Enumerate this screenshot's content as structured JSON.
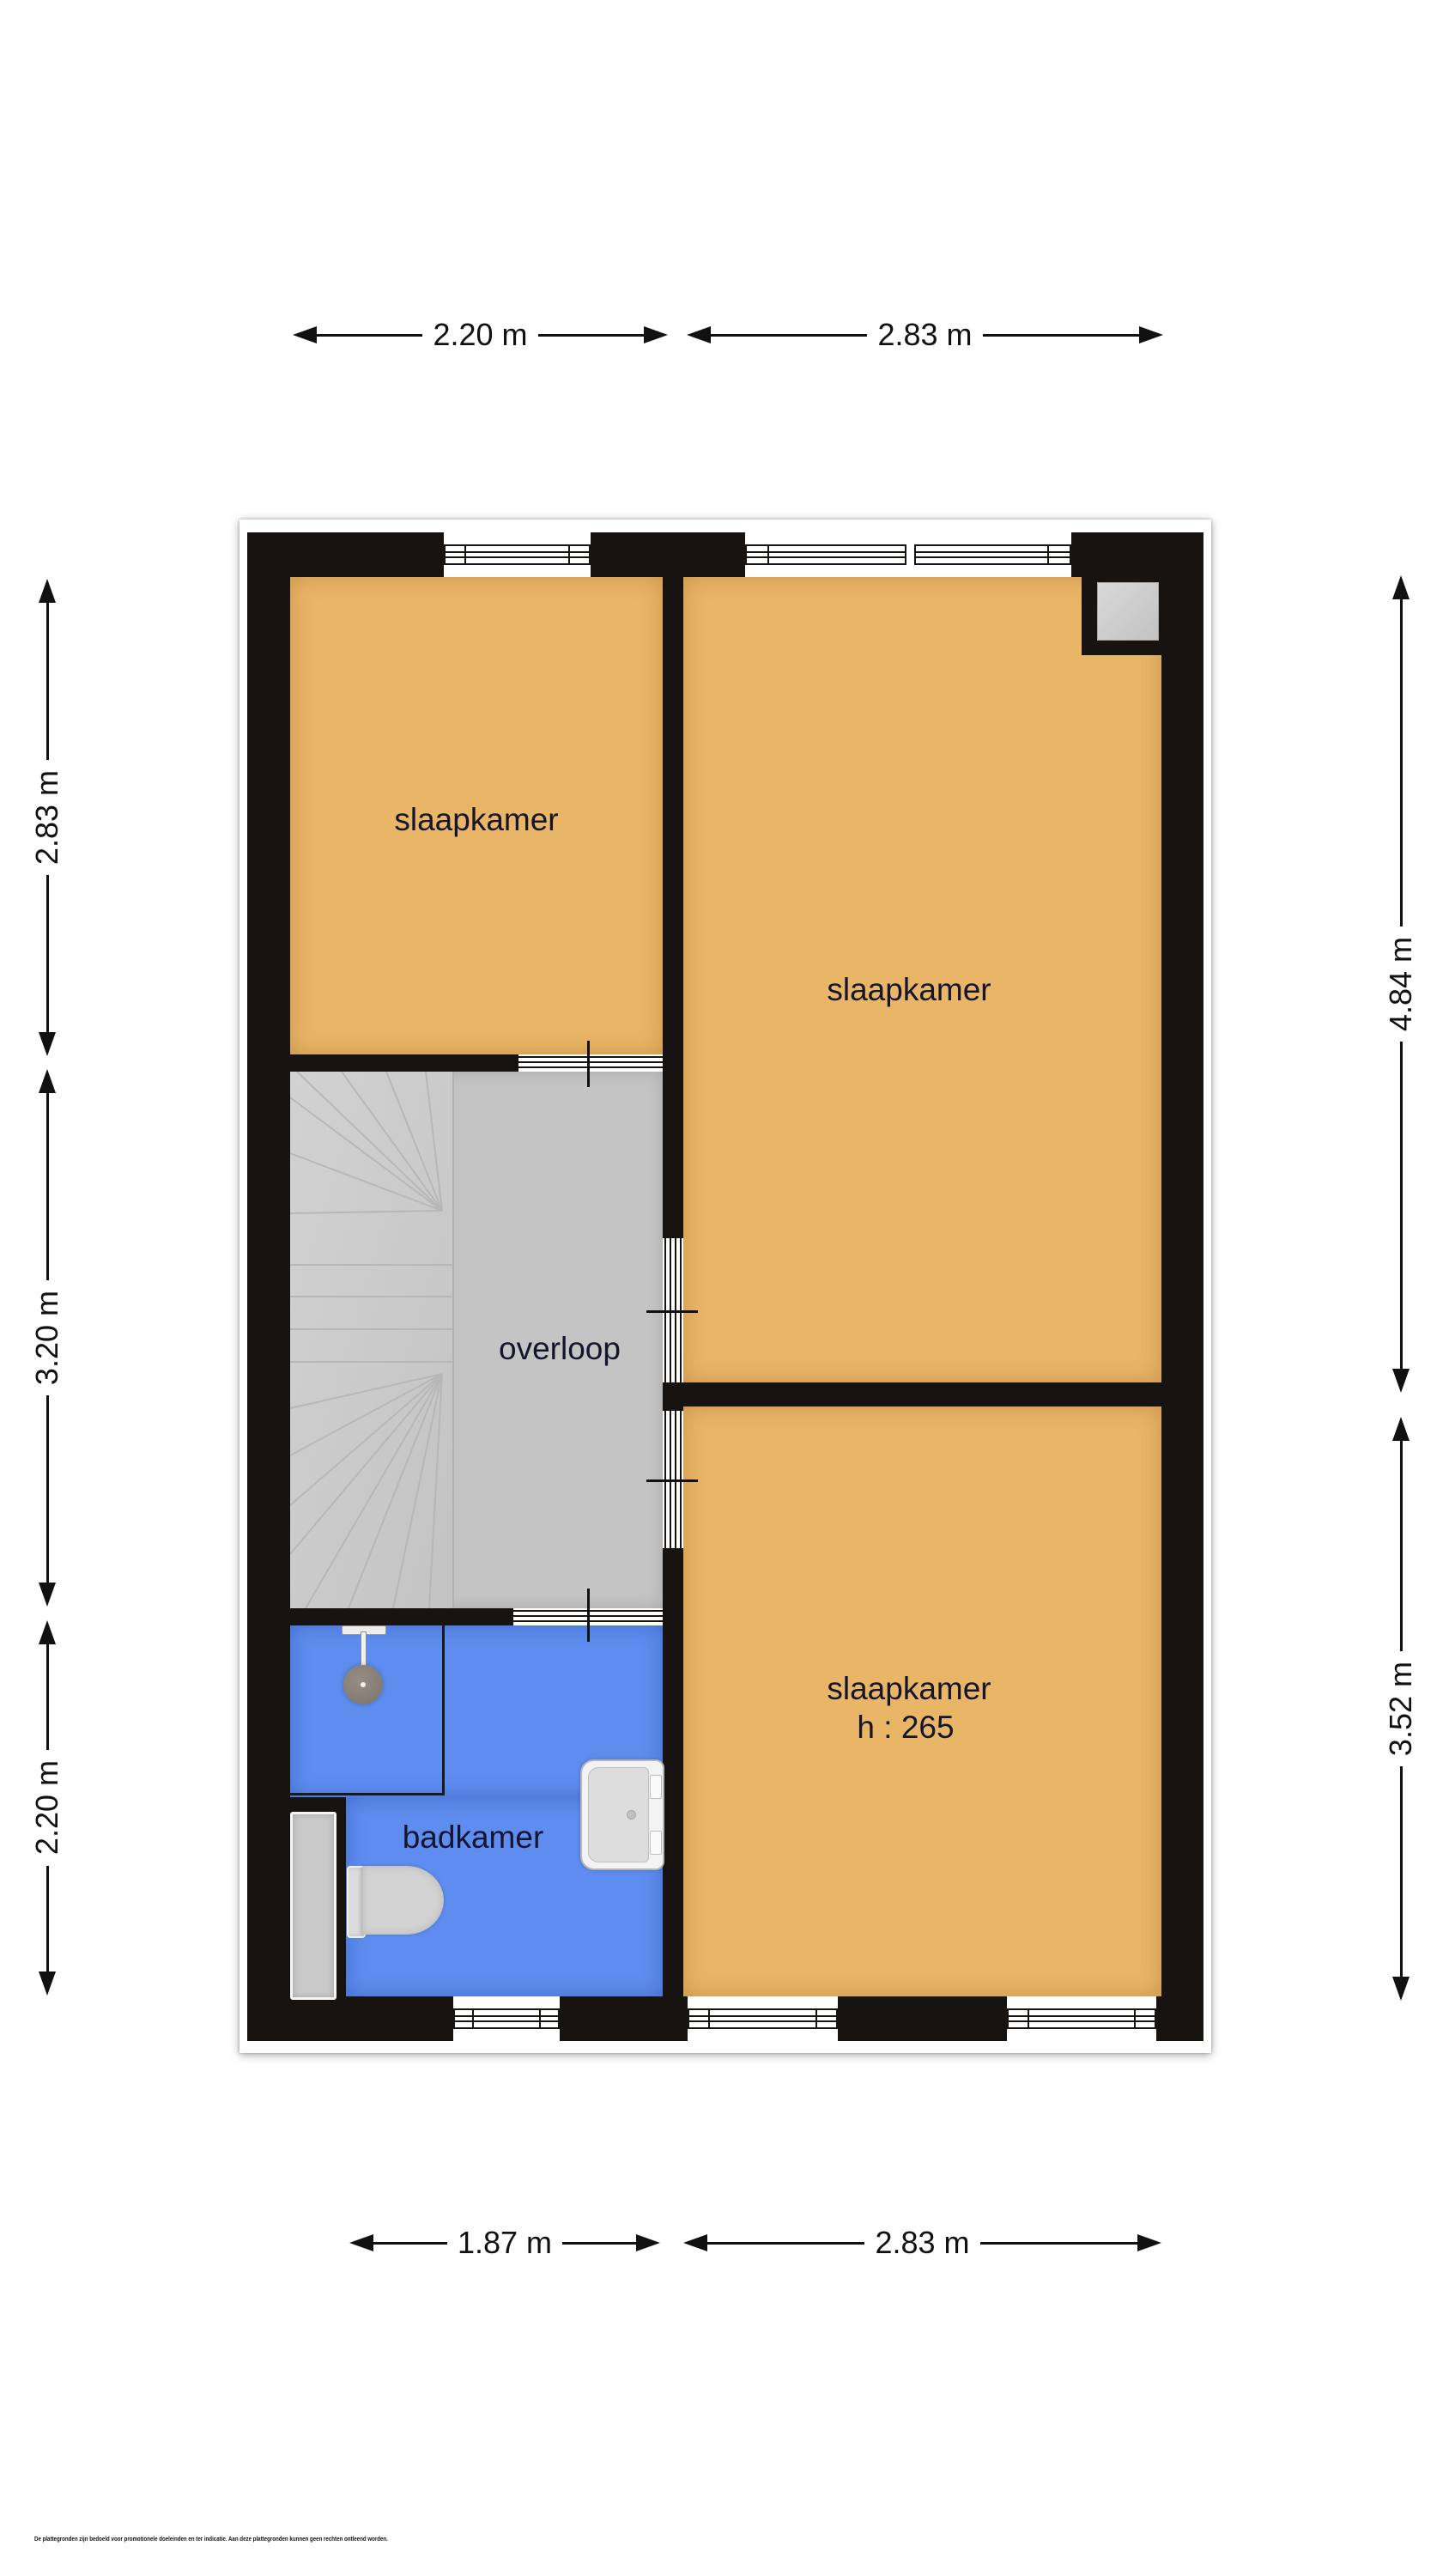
{
  "rooms": [
    {
      "id": "bedroom-top-left",
      "label": "slaapkamer"
    },
    {
      "id": "bedroom-right",
      "label": "slaapkamer"
    },
    {
      "id": "bedroom-bottom-right",
      "label": "slaapkamer",
      "ceiling_height": "h : 265"
    },
    {
      "id": "landing",
      "label": "overloop"
    },
    {
      "id": "bathroom",
      "label": "badkamer"
    }
  ],
  "dimensions": {
    "top": [
      {
        "label": "2.20 m"
      },
      {
        "label": "2.83 m"
      }
    ],
    "bottom": [
      {
        "label": "1.87 m"
      },
      {
        "label": "2.83 m"
      }
    ],
    "left": [
      {
        "label": "2.83 m"
      },
      {
        "label": "3.20 m"
      },
      {
        "label": "2.20 m"
      }
    ],
    "right": [
      {
        "label": "4.84 m"
      },
      {
        "label": "3.52 m"
      }
    ]
  },
  "fixtures": [
    {
      "name": "winder-stairs"
    },
    {
      "name": "shower-head"
    },
    {
      "name": "toilet"
    },
    {
      "name": "washbasin"
    },
    {
      "name": "radiator"
    },
    {
      "name": "chimney-duct"
    }
  ],
  "disclaimer": "De plattegronden zijn bedoeld voor promotionele doeleinden en ter indicatie. Aan deze plattegronden kunnen geen rechten ontleend worden.",
  "colors": {
    "wall": "#171310",
    "bedroom_floor": "#e9b566",
    "bathroom_floor": "#5e8def",
    "landing_floor": "#c4c4c4",
    "stairs_floor": "#cbcbcb",
    "room_label_text": "#15152e",
    "dimension_ink": "#111111",
    "background": "#ffffff"
  }
}
